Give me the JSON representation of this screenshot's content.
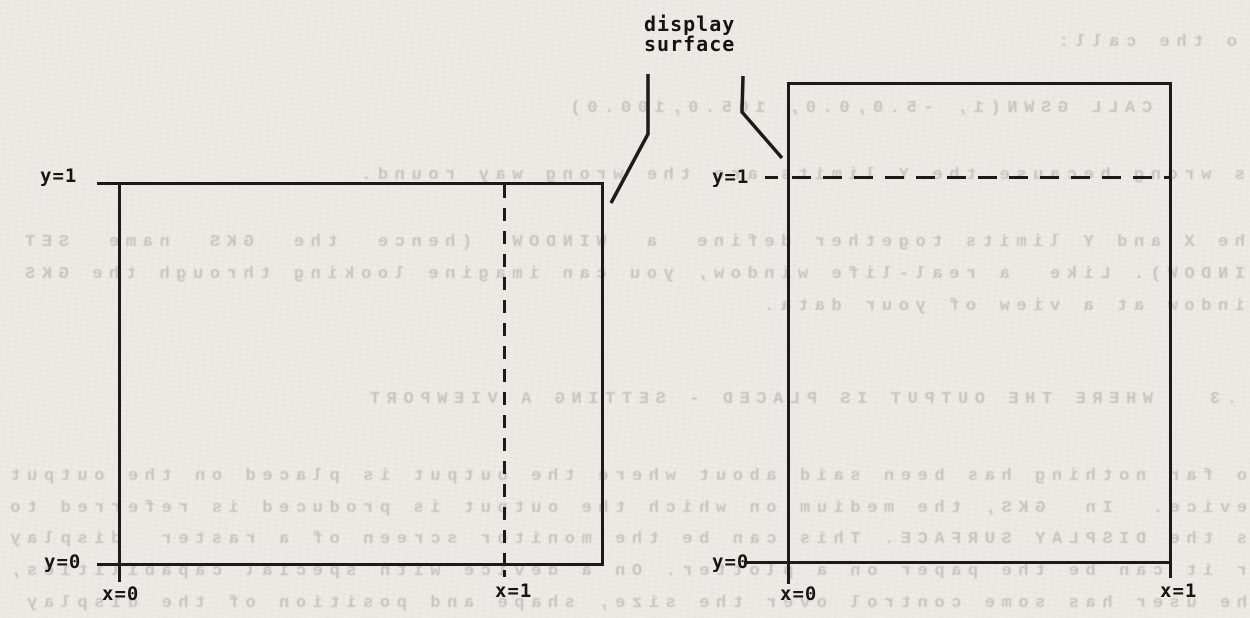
{
  "colors": {
    "paper": "#edebe6",
    "ink": "#1b1b1b",
    "bleed_text": "#c6c4bf"
  },
  "figure": {
    "caption": {
      "line1": "display",
      "line2": "surface"
    },
    "left_panel": {
      "y_top": "y=1",
      "y_bottom": "y=0",
      "x_left": "x=0",
      "x_right": "x=1"
    },
    "right_panel": {
      "y_top": "y=1",
      "y_bottom": "y=0",
      "x_left": "x=0",
      "x_right": "x=1"
    }
  },
  "bleed_lines": [
    {
      "text": "o the call:",
      "left": 13,
      "top": 33
    },
    {
      "text": "CALL GSWN(1, -5.0,0.0, 105.0,100.0)",
      "left": 98,
      "top": 99
    },
    {
      "text": "s wrong because the Y limits are the wrong way round.",
      "left": 5,
      "top": 166
    },
    {
      "text": "he X and Y limits together define  a  WINDOW  (hence  the  GKS  name  SET",
      "left": 5,
      "top": 233
    },
    {
      "text": "INDOW). Like  a real-life window, you can imagine looking through the GKS",
      "left": 5,
      "top": 265
    },
    {
      "text": "indow at a view of your data.",
      "left": 5,
      "top": 297
    },
    {
      "text": ".3   WHERE THE OUTPUT IS PLACED - SETTING A VIEWPORT",
      "left": 13,
      "top": 390
    },
    {
      "text": "o far nothing has been said about where the output is placed on the output",
      "left": 3,
      "top": 467
    },
    {
      "text": "evice.  In  GKS, the medium on which the output is produced is referred to",
      "left": 3,
      "top": 499
    },
    {
      "text": "s the DISPLAY SURFACE. This can be the monitor screen of a raster  display",
      "left": 3,
      "top": 530
    },
    {
      "text": "r it can be the paper on a plotter. On a device with special capabilities,",
      "left": 3,
      "top": 562
    },
    {
      "text": "he user has some control over the size, shape and position of the display",
      "left": 3,
      "top": 594
    }
  ]
}
